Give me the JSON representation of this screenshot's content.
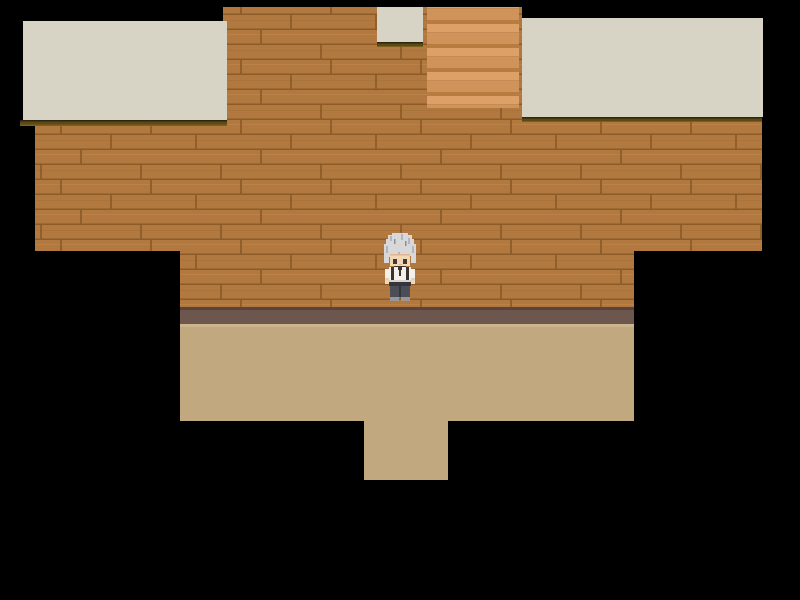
{
  "window": {
    "width_px": 800,
    "height_px": 600
  },
  "scene": {
    "kind": "top-down RPG tile map (exterior rooftop/house view)",
    "visible_text": "none",
    "materials": {
      "wall": "horizontal brown wood planks with staggered joints",
      "roof_strips": "plain cream awnings with dark olive eave edge",
      "panel": "lighter orange striped wood panel",
      "baseboard": "muted mauve-brown strip at wall base",
      "ground": "plain tan floor",
      "void": "black unexplored area"
    }
  },
  "character": {
    "role": "player character sprite",
    "facing": "down (toward viewer)",
    "hair": "silver, messy",
    "outfit": "white long-sleeve shirt with dark suspenders and collar, dark gray trousers, gray shoes",
    "screen_position": {
      "x": 400,
      "y": 267
    }
  },
  "colors": {
    "bg": "#000000",
    "wood_base": "#b1793f",
    "wood_seam": "#8c5b28",
    "wood_light": "#c68a4f",
    "wood_dark": "#9c6731",
    "panel_base": "#d0935a",
    "panel_light": "#dda167",
    "panel_mid": "#c08850",
    "panel_dark": "#b87c40",
    "roof_cream": "#d7d3c5",
    "eave_black": "#2e2410",
    "eave_olive": "#5c4a12",
    "eave_light": "#7a6020",
    "base_shadow": "#57443c",
    "baseboard": "#6d564d",
    "floor_light": "#ccb48c",
    "floor_tan": "#c1a87e",
    "hair_light": "#d8d8db",
    "hair_mid": "#b4b4bc",
    "hair_dark": "#8e8e99",
    "skin": "#f3d7b5",
    "skin_shade": "#dfb68f",
    "eye": "#423a34",
    "shirt": "#f4f1ea",
    "shirt_shade": "#d9d4c9",
    "strap": "#3a3330",
    "pants": "#4b4e57",
    "pants_dark": "#34363d",
    "shoe": "#97979b"
  }
}
